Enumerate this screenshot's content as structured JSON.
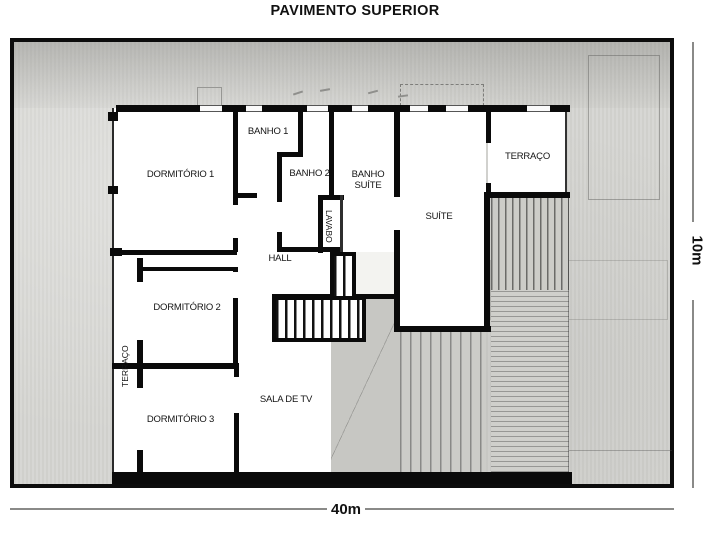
{
  "title": "PAVIMENTO SUPERIOR",
  "rooms": {
    "dormitorio1": "DORMITÓRIO 1",
    "banho1": "BANHO 1",
    "banho2": "BANHO 2",
    "banho_suite": "BANHO SUÍTE",
    "lavabo": "LAVABO",
    "suite": "SUÍTE",
    "terraco_direita": "TERRAÇO",
    "hall": "HALL",
    "dormitorio2": "DORMITÓRIO 2",
    "terraco_esquerda": "TERRAÇO",
    "dormitorio3": "DORMITÓRIO 3",
    "sala_de_tv": "SALA DE TV"
  },
  "dimensions": {
    "width_label": "40m",
    "height_label": "10m"
  },
  "colors": {
    "wall": "#0a0a0a",
    "site_background": "#d6d6d2",
    "room_background": "#ffffff"
  }
}
